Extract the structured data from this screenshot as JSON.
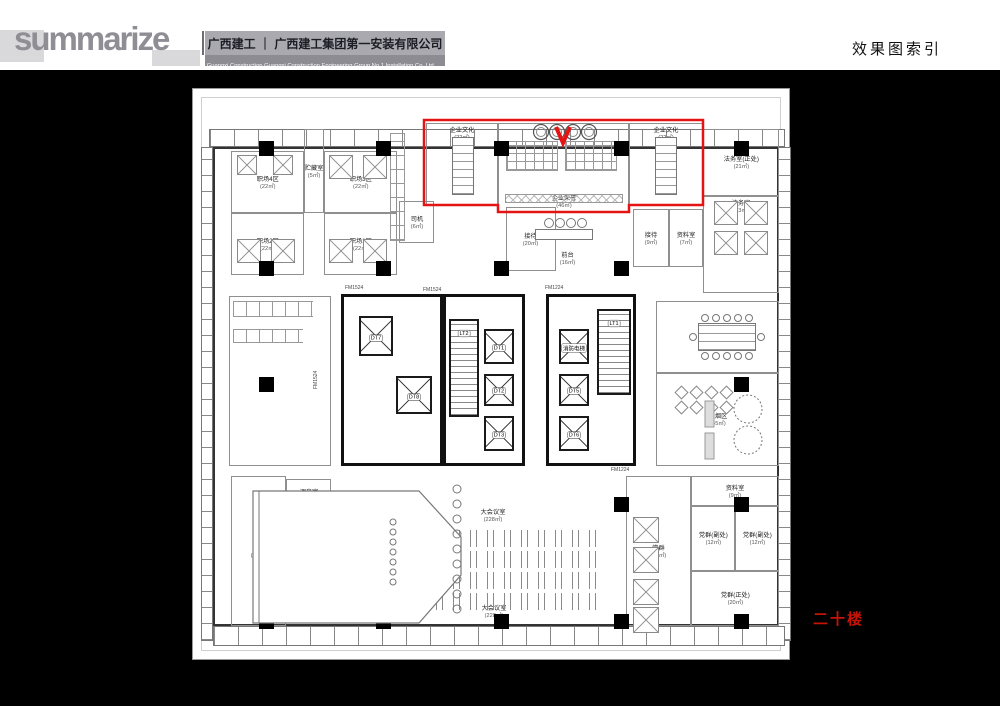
{
  "header": {
    "logo": "summarize",
    "company_cn": "广西建工 ｜ 广西建工集团第一安装有限公司",
    "company_en": "Guangxi Construction      Guangxi Construction Engineering Group No.1 Installation Co.,Ltd",
    "page_title": "效果图索引"
  },
  "floor_label": "二十楼",
  "colors": {
    "highlight": "#e41414",
    "floor_text": "#c51405",
    "logo_gray": "#8e8e94",
    "header_band": "#a9a9af",
    "header_band_dark": "#8c8c92",
    "background": "#000000"
  },
  "plan": {
    "rooms": [
      {
        "n": "职场4区",
        "a": "22㎡",
        "x": 38,
        "y": 62,
        "w": 73,
        "h": 62
      },
      {
        "n": "贮藏室",
        "a": "5㎡",
        "x": 111,
        "y": 40,
        "w": 20,
        "h": 84
      },
      {
        "n": "职场3区",
        "a": "22㎡",
        "x": 131,
        "y": 62,
        "w": 73,
        "h": 62
      },
      {
        "n": "职场2区",
        "a": "22㎡",
        "x": 38,
        "y": 124,
        "w": 73,
        "h": 62
      },
      {
        "n": "职场1区",
        "a": "22㎡",
        "x": 131,
        "y": 124,
        "w": 73,
        "h": 62
      },
      {
        "n": "司机",
        "a": "6㎡",
        "x": 206,
        "y": 112,
        "w": 35,
        "h": 42
      },
      {
        "n": "企业文化",
        "a": "22㎡",
        "x": 233,
        "y": 34,
        "w": 72,
        "h": 82,
        "lp": "t"
      },
      {
        "n": "企业荣誉",
        "a": "46㎡",
        "x": 305,
        "y": 34,
        "w": 131,
        "h": 89,
        "lp": "b"
      },
      {
        "n": "企业文化",
        "a": "22㎡",
        "x": 436,
        "y": 34,
        "w": 74,
        "h": 82,
        "lp": "t"
      },
      {
        "n": "法务室(正处)",
        "a": "21㎡",
        "x": 510,
        "y": 40,
        "w": 76,
        "h": 67
      },
      {
        "n": "法务室",
        "a": "23㎡",
        "x": 510,
        "y": 107,
        "w": 76,
        "h": 97,
        "lp": "t"
      },
      {
        "n": "接待",
        "a": "20㎡",
        "x": 313,
        "y": 118,
        "w": 50,
        "h": 64
      },
      {
        "n": "前台",
        "a": "16㎡",
        "x": 340,
        "y": 152,
        "w": 70,
        "h": 34,
        "t": "zone"
      },
      {
        "n": "接待",
        "a": "9㎡",
        "x": 440,
        "y": 120,
        "w": 36,
        "h": 58
      },
      {
        "n": "资料室",
        "a": "7㎡",
        "x": 476,
        "y": 120,
        "w": 34,
        "h": 58
      },
      {
        "n": "",
        "a": "",
        "x": 36,
        "y": 207,
        "w": 102,
        "h": 170
      },
      {
        "n": "小会议室",
        "a": "46㎡",
        "x": 463,
        "y": 212,
        "w": 123,
        "h": 72
      },
      {
        "n": "吸烟区",
        "a": "45㎡",
        "x": 463,
        "y": 284,
        "w": 123,
        "h": 93
      },
      {
        "n": "调音室",
        "a": "7㎡",
        "x": 93,
        "y": 390,
        "w": 45,
        "h": 32
      },
      {
        "n": "后台",
        "a": "45㎡",
        "x": 38,
        "y": 387,
        "w": 55,
        "h": 150
      },
      {
        "n": "舞台",
        "a": "58㎡",
        "x": 96,
        "y": 440,
        "w": 60,
        "h": 70,
        "t": "zone"
      },
      {
        "n": "大会议室",
        "a": "228㎡",
        "x": 255,
        "y": 418,
        "w": 90,
        "h": 16,
        "t": "zone"
      },
      {
        "n": "大会议室",
        "a": "228㎡",
        "x": 256,
        "y": 514,
        "w": 90,
        "h": 16,
        "t": "zone"
      },
      {
        "n": "资料室",
        "a": "9㎡",
        "x": 498,
        "y": 387,
        "w": 88,
        "h": 30
      },
      {
        "n": "党群(副处)",
        "a": "12㎡",
        "x": 498,
        "y": 417,
        "w": 44,
        "h": 65
      },
      {
        "n": "党群(副处)",
        "a": "12㎡",
        "x": 542,
        "y": 417,
        "w": 44,
        "h": 65
      },
      {
        "n": "党群",
        "a": "25㎡",
        "x": 433,
        "y": 387,
        "w": 65,
        "h": 150
      },
      {
        "n": "党群(正处)",
        "a": "20㎡",
        "x": 498,
        "y": 482,
        "w": 88,
        "h": 55
      }
    ],
    "cores": [
      {
        "x": 148,
        "y": 205,
        "w": 102,
        "h": 172
      },
      {
        "x": 250,
        "y": 205,
        "w": 82,
        "h": 172
      },
      {
        "x": 353,
        "y": 205,
        "w": 90,
        "h": 172
      }
    ],
    "elevators": [
      {
        "label": "DT7",
        "x": 166,
        "y": 227,
        "w": 34,
        "h": 40
      },
      {
        "label": "DT8",
        "x": 203,
        "y": 287,
        "w": 36,
        "h": 38
      },
      {
        "label": "DT1",
        "x": 291,
        "y": 240,
        "w": 30,
        "h": 35
      },
      {
        "label": "DT2",
        "x": 291,
        "y": 285,
        "w": 30,
        "h": 32
      },
      {
        "label": "DT3",
        "x": 291,
        "y": 327,
        "w": 30,
        "h": 35
      },
      {
        "label": "消防电梯",
        "x": 366,
        "y": 240,
        "w": 30,
        "h": 35
      },
      {
        "label": "DT5",
        "x": 366,
        "y": 285,
        "w": 30,
        "h": 32
      },
      {
        "label": "DT6",
        "x": 366,
        "y": 327,
        "w": 30,
        "h": 35
      }
    ],
    "stairs": [
      {
        "label": "LT2",
        "x": 256,
        "y": 230,
        "w": 30,
        "h": 98
      },
      {
        "label": "LT1",
        "x": 404,
        "y": 220,
        "w": 34,
        "h": 86
      }
    ],
    "door_tags": [
      {
        "v": "FM1524",
        "x": 152,
        "y": 196
      },
      {
        "v": "FM1524",
        "x": 230,
        "y": 198
      },
      {
        "v": "FM1524",
        "x": 120,
        "y": 300,
        "vert": true
      },
      {
        "v": "FM1224",
        "x": 352,
        "y": 196
      },
      {
        "v": "FM1224",
        "x": 418,
        "y": 378
      }
    ],
    "columns": [
      [
        73,
        59
      ],
      [
        190,
        59
      ],
      [
        308,
        59
      ],
      [
        428,
        59
      ],
      [
        548,
        59
      ],
      [
        73,
        179
      ],
      [
        190,
        179
      ],
      [
        308,
        179
      ],
      [
        428,
        179
      ],
      [
        73,
        295
      ],
      [
        548,
        295
      ],
      [
        73,
        415
      ],
      [
        428,
        415
      ],
      [
        548,
        415
      ],
      [
        73,
        532
      ],
      [
        190,
        532
      ],
      [
        308,
        532
      ],
      [
        428,
        532
      ],
      [
        548,
        532
      ]
    ],
    "furniture": [
      {
        "k": "tbl grid-v",
        "x": 259,
        "y": 48,
        "w": 22,
        "h": 58
      },
      {
        "k": "tbl grid-v",
        "x": 462,
        "y": 48,
        "w": 22,
        "h": 58
      },
      {
        "k": "pat-seats",
        "x": 313,
        "y": 52,
        "w": 52,
        "h": 30
      },
      {
        "k": "pat-seats",
        "x": 372,
        "y": 52,
        "w": 52,
        "h": 30
      },
      {
        "k": "pat-x",
        "x": 312,
        "y": 105,
        "w": 118,
        "h": 9
      },
      {
        "k": "tbl",
        "x": 342,
        "y": 140,
        "w": 58,
        "h": 11
      },
      {
        "k": "pat-conf",
        "x": 192,
        "y": 437,
        "w": 220,
        "h": 84
      },
      {
        "k": "pat-stall",
        "x": 40,
        "y": 212,
        "w": 80,
        "h": 16
      },
      {
        "k": "pat-stall",
        "x": 40,
        "y": 240,
        "w": 70,
        "h": 14
      },
      {
        "k": "tbl grid-v",
        "x": 505,
        "y": 234,
        "w": 58,
        "h": 28
      },
      {
        "k": "pat-rows",
        "x": 197,
        "y": 44,
        "w": 15,
        "h": 108
      },
      {
        "k": "tbl grid-v",
        "x": 205,
        "y": 425,
        "w": 22,
        "h": 82
      }
    ],
    "clusters": [
      {
        "x": 44,
        "y": 66,
        "s": 20
      },
      {
        "x": 80,
        "y": 66,
        "s": 20
      },
      {
        "x": 136,
        "y": 66,
        "s": 24
      },
      {
        "x": 170,
        "y": 66,
        "s": 24
      },
      {
        "x": 44,
        "y": 150,
        "s": 24
      },
      {
        "x": 78,
        "y": 150,
        "s": 24
      },
      {
        "x": 136,
        "y": 150,
        "s": 24
      },
      {
        "x": 170,
        "y": 150,
        "s": 24
      },
      {
        "x": 521,
        "y": 112,
        "s": 24
      },
      {
        "x": 551,
        "y": 112,
        "s": 24
      },
      {
        "x": 521,
        "y": 142,
        "s": 24
      },
      {
        "x": 551,
        "y": 142,
        "s": 24
      },
      {
        "x": 440,
        "y": 428,
        "s": 26
      },
      {
        "x": 440,
        "y": 458,
        "s": 26
      },
      {
        "x": 440,
        "y": 490,
        "s": 26
      },
      {
        "x": 440,
        "y": 518,
        "s": 26
      }
    ]
  }
}
